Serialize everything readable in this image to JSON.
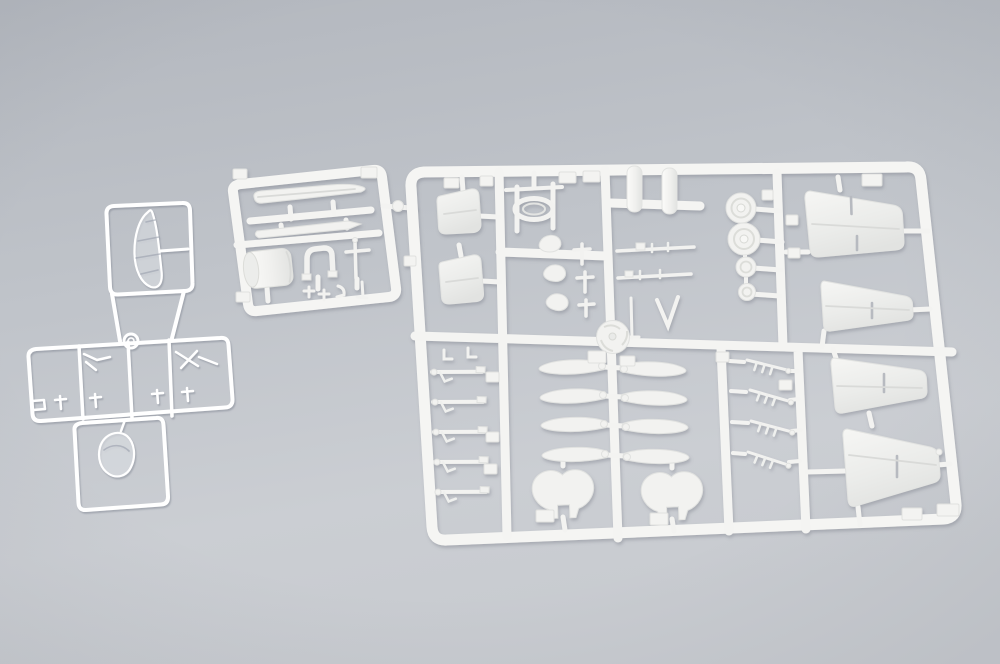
{
  "scene": {
    "type": "product-photograph",
    "description": "Overhead photo of plastic aircraft model kit sprues: two clear sprues on the left and two white styrene sprues on the right, lying on a neutral gray studio surface.",
    "background": {
      "top_color": "#b3b7be",
      "bottom_color": "#cacdd2",
      "surface": "seamless gray"
    },
    "plastic": {
      "white_styrene": "#f4f4f2",
      "white_shadow": "#6f7580",
      "clear_styrene_highlight": "#ffffff",
      "clear_shadow": "#858b96"
    }
  },
  "sprues": [
    {
      "id": "clear-canopy-sprue",
      "material": "clear",
      "label": "Small clear sprue holding the one-piece cockpit canopy",
      "parts": [
        {
          "name": "canopy",
          "count": 1
        }
      ]
    },
    {
      "id": "clear-small-parts-sprue",
      "material": "clear",
      "label": "Flat clear sprue with windscreen and small transparent fittings",
      "parts": [
        {
          "name": "windscreen",
          "count": 1
        },
        {
          "name": "small-clear-fittings",
          "count": 7
        }
      ]
    },
    {
      "id": "white-small-sprue",
      "material": "white styrene",
      "label": "Small white sprue with drop tank, engine cowling and small fittings",
      "parts": [
        {
          "name": "drop-tank-half",
          "count": 1
        },
        {
          "name": "keel-blade",
          "count": 1
        },
        {
          "name": "engine-cowling",
          "count": 1
        },
        {
          "name": "cowl-arch",
          "count": 1
        },
        {
          "name": "cross-brace",
          "count": 1
        },
        {
          "name": "small-fittings",
          "count": 4
        }
      ]
    },
    {
      "id": "white-main-sprue",
      "material": "white styrene",
      "label": "Large white sprue with wing panels, propeller blades, wheels and landing gear",
      "parts": [
        {
          "name": "wing-panel",
          "count": 4
        },
        {
          "name": "tailplane-panel",
          "count": 2
        },
        {
          "name": "propeller-blade",
          "count": 8
        },
        {
          "name": "propeller-spinner",
          "count": 1
        },
        {
          "name": "wheel",
          "count": 4
        },
        {
          "name": "drop-tank",
          "count": 2
        },
        {
          "name": "exhaust-stack",
          "count": 3
        },
        {
          "name": "wheel-cover",
          "count": 2
        },
        {
          "name": "landing-gear-strut",
          "count": 5
        },
        {
          "name": "gun-barrel",
          "count": 4
        },
        {
          "name": "cockpit-frame",
          "count": 1
        }
      ]
    }
  ]
}
